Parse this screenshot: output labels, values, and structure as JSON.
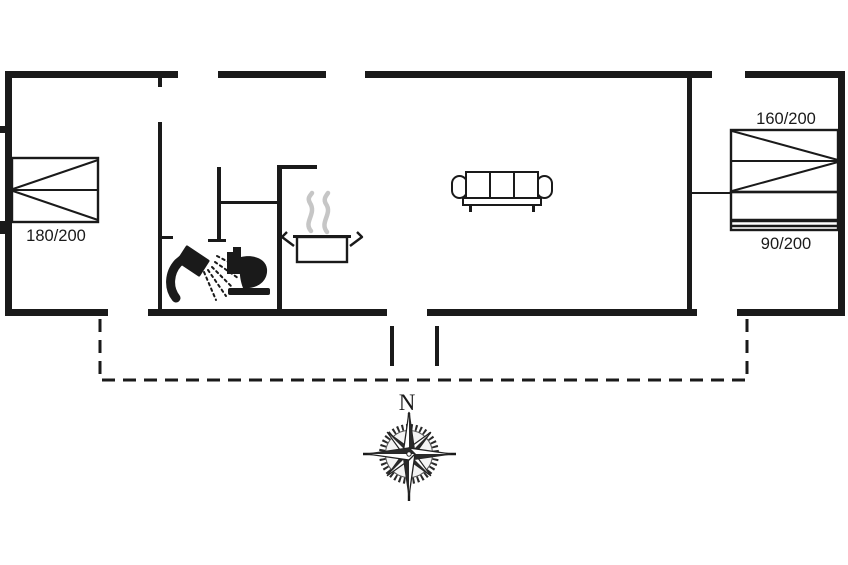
{
  "floor_plan": {
    "bed_labels": {
      "left_double": "180/200",
      "right_double": "160/200",
      "right_single": "90/200"
    },
    "compass": {
      "north_label": "N"
    },
    "colors": {
      "line": "#1a1a1a",
      "steam": "#c6c6c6",
      "background": "#ffffff"
    }
  }
}
